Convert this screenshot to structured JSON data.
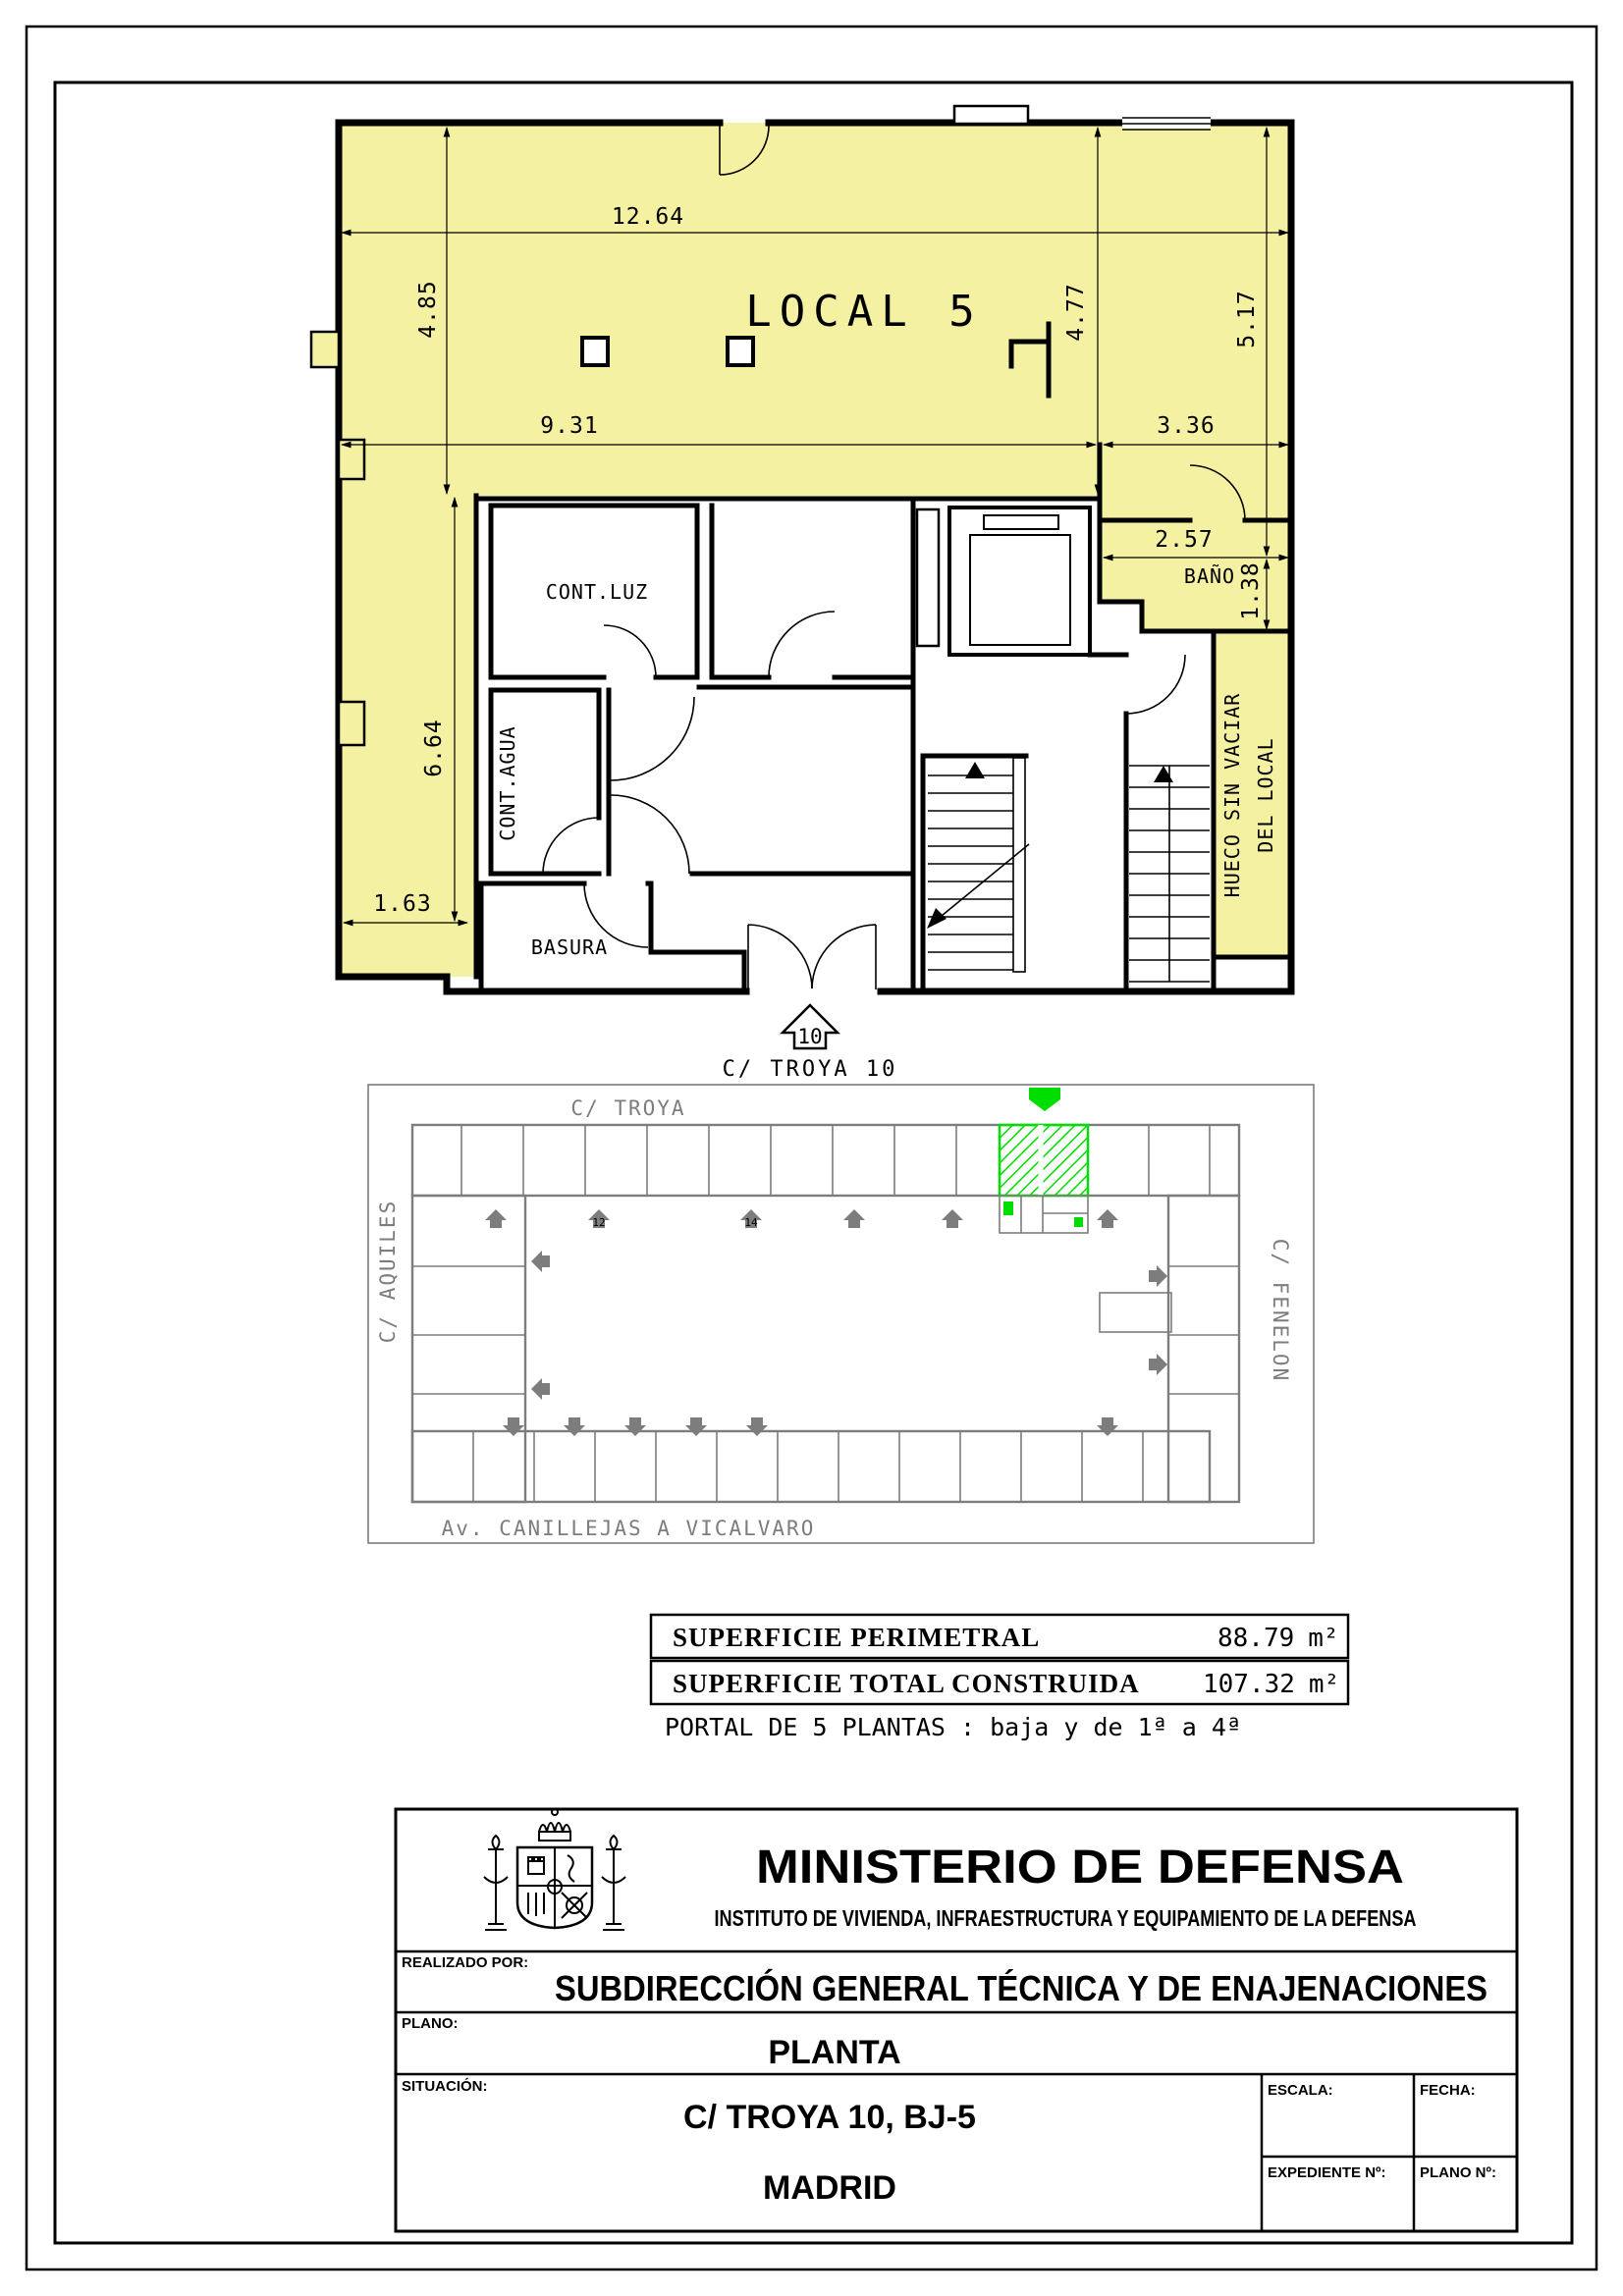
{
  "floor_plan": {
    "title": "LOCAL 5",
    "highlight_fill": "#f5f1a3",
    "rooms": {
      "cont_luz": "CONT.LUZ",
      "cont_agua": "CONT.AGUA",
      "basura": "BASURA",
      "bano": "BAÑO"
    },
    "hueco_label": {
      "line1": "HUECO SIN VACIAR",
      "line2": "DEL LOCAL"
    },
    "entrance": {
      "portal_number": "10",
      "street": "C/ TROYA 10"
    },
    "dimensions": {
      "top_width": "12.64",
      "upper_left_height": "4.85",
      "mid_width": "9.31",
      "mid_right_height": "4.77",
      "right_height": "5.17",
      "corridor_width": "3.36",
      "bano_width": "2.57",
      "bano_height": "1.38",
      "left_strip_height": "6.64",
      "left_strip_width": "1.63"
    }
  },
  "site_plan": {
    "streets": {
      "top": "C/ TROYA",
      "left": "C/ AQUILES",
      "right": "C/ FENELON",
      "bottom": "Av. CANILLEJAS A VICALVARO"
    },
    "portal_numbers": [
      "12",
      "14"
    ],
    "highlight_color": "#00dd00",
    "line_color": "#7d7d7d"
  },
  "summary": {
    "rows": [
      {
        "label": "SUPERFICIE PERIMETRAL",
        "value": "88.79",
        "unit": "m²"
      },
      {
        "label": "SUPERFICIE TOTAL CONSTRUIDA",
        "value": "107.32",
        "unit": "m²"
      }
    ],
    "note": "PORTAL DE 5 PLANTAS : baja y de 1ª a 4ª"
  },
  "title_block": {
    "ministry": "MINISTERIO DE DEFENSA",
    "institute": "INSTITUTO DE VIVIENDA, INFRAESTRUCTURA Y EQUIPAMIENTO DE LA DEFENSA",
    "realizado_label": "REALIZADO POR:",
    "realizado": "SUBDIRECCIÓN GENERAL TÉCNICA Y DE ENAJENACIONES",
    "plano_label": "PLANO:",
    "plano": "PLANTA",
    "situacion_label": "SITUACIÓN:",
    "situacion_address": "C/ TROYA 10, BJ-5",
    "situacion_city": "MADRID",
    "escala_label": "ESCALA:",
    "fecha_label": "FECHA:",
    "expediente_label": "EXPEDIENTE Nº:",
    "plano_num_label": "PLANO Nº:"
  }
}
